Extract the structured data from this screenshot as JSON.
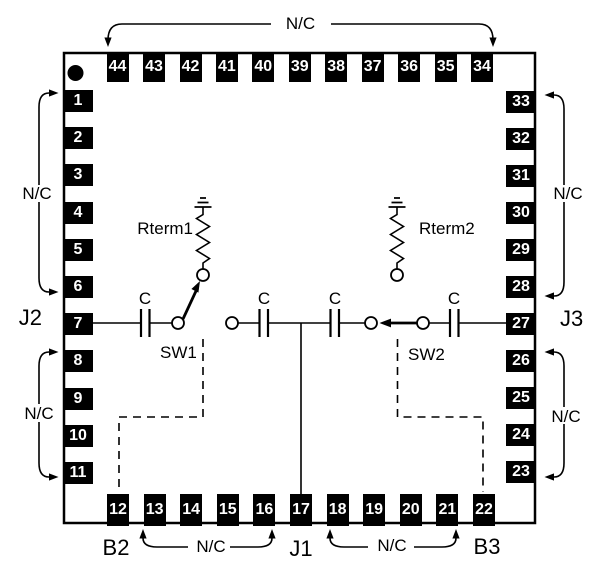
{
  "pins": {
    "top": [
      "44",
      "43",
      "42",
      "41",
      "40",
      "39",
      "38",
      "37",
      "36",
      "35",
      "34"
    ],
    "left": [
      "1",
      "2",
      "3",
      "4",
      "5",
      "6",
      "7",
      "8",
      "9",
      "10",
      "11"
    ],
    "right": [
      "33",
      "32",
      "31",
      "30",
      "29",
      "28",
      "27",
      "26",
      "25",
      "24",
      "23"
    ],
    "bottom": [
      "12",
      "13",
      "14",
      "15",
      "16",
      "17",
      "18",
      "19",
      "20",
      "21",
      "22"
    ]
  },
  "labels": {
    "nc_top": "N/C",
    "nc_left_upper": "N/C",
    "nc_left_lower": "N/C",
    "nc_right_upper": "N/C",
    "nc_right_lower": "N/C",
    "nc_bottom_left": "N/C",
    "nc_bottom_right": "N/C",
    "j1": "J1",
    "j2": "J2",
    "j3": "J3",
    "b2": "B2",
    "b3": "B3",
    "sw1": "SW1",
    "sw2": "SW2",
    "rterm1": "Rterm1",
    "rterm2": "Rterm2",
    "cap1": "C",
    "cap2": "C",
    "cap3": "C",
    "cap4": "C"
  },
  "colors": {
    "ink": "#000000",
    "pin_fill": "#000000",
    "pin_text": "#ffffff",
    "background": "#ffffff"
  }
}
